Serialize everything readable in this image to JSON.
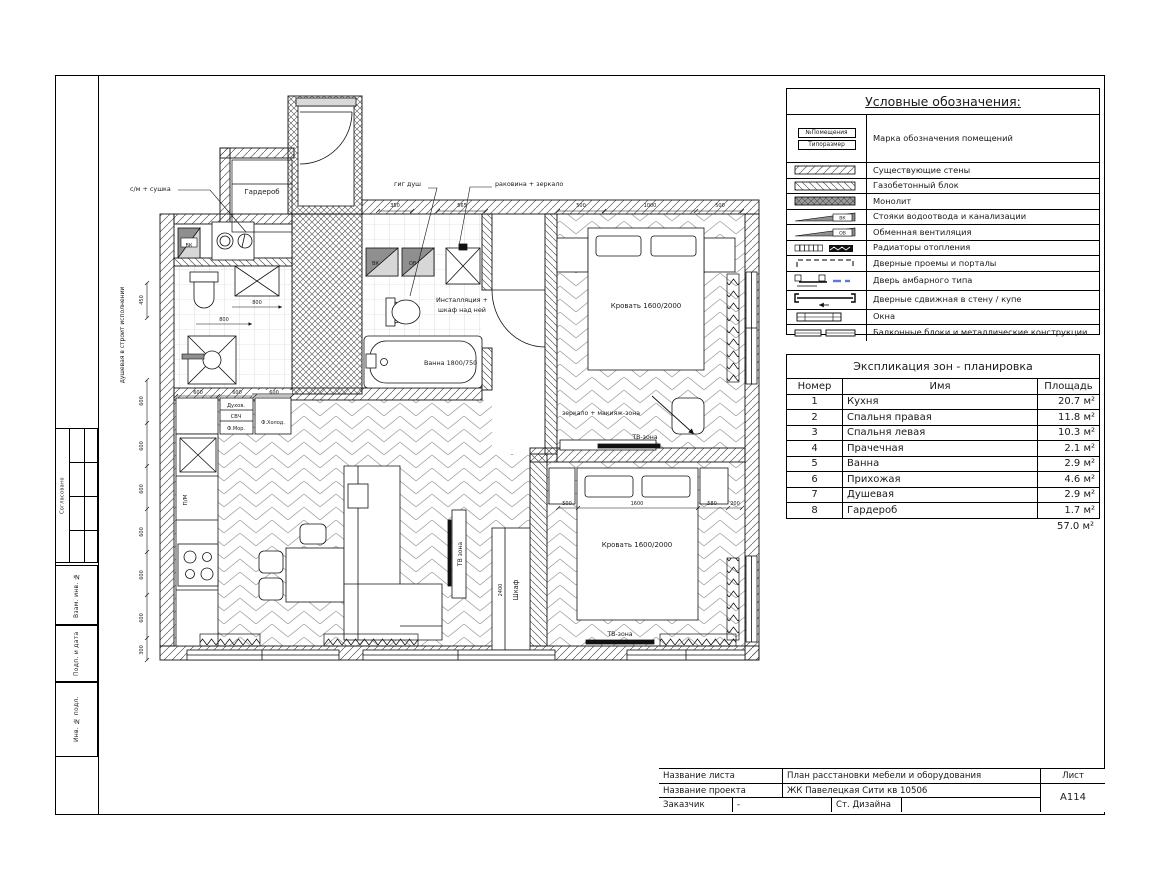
{
  "sheet": {
    "stamps": [
      "Согласовано",
      "Взам. инв. №",
      "Подп. и дата",
      "Инв. № подл."
    ]
  },
  "legend": {
    "title": "Условные обозначения:",
    "room_tag_top": "№Помещения",
    "room_tag_bottom": "Типоразмер",
    "vk": "ВК",
    "ov": "ОВ",
    "items": [
      "Марка обозначения помещений",
      "Существующие стены",
      "Газобетонный блок",
      "Монолит",
      "Стояки водоотвода и канализации",
      "Обменная вентиляция",
      "Радиаторы отопления",
      "Дверные проемы и порталы",
      "Дверь амбарного типа",
      "Дверные сдвижная в стену / купе",
      "Окна",
      "Балконные блоки и металлические конструкции"
    ]
  },
  "zones_table": {
    "title": "Экспликация зон - планировка",
    "headers": [
      "Номер",
      "Имя",
      "Площадь"
    ],
    "rows": [
      [
        "1",
        "Кухня",
        "20.7 м²"
      ],
      [
        "2",
        "Спальня правая",
        "11.8 м²"
      ],
      [
        "3",
        "Спальня левая",
        "10.3 м²"
      ],
      [
        "4",
        "Прачечная",
        "2.1 м²"
      ],
      [
        "5",
        "Ванна",
        "2.9 м²"
      ],
      [
        "6",
        "Прихожая",
        "4.6 м²"
      ],
      [
        "7",
        "Душевая",
        "2.9 м²"
      ],
      [
        "8",
        "Гардероб",
        "1.7 м²"
      ]
    ],
    "total": "57.0 м²"
  },
  "title_block": {
    "sheet_name_label": "Название листа",
    "sheet_name": "План расстановки мебели и оборудования",
    "project_label": "Название проекта",
    "project": "ЖК Павелецкая Сити кв 10506",
    "client_label": "Заказчик",
    "client": "-",
    "studio": "Ст. Дизайна",
    "sheet_label": "Лист",
    "sheet_number": "А114"
  },
  "plan": {
    "labels": {
      "washer": "с/м + сушка",
      "wardrobe_room": "Гардероб",
      "gig_shower": "гиг душ",
      "sink_mirror": "раковина + зеркало",
      "installation1": "Инсталляция +",
      "installation2": "шкаф над ней",
      "bath": "Ванна 1800/750",
      "bed_right": "Кровать 1600/2000",
      "bed_left": "Кровать 1600/2000",
      "mirror_makeup": "зеркало + макияж-зона",
      "tv_zone_right": "ТВ-зона",
      "tv_zone_left": "ТВ-зона",
      "tv_zone_living": "ТВ зона",
      "wardrobe_cab": "Шкаф",
      "oven": "Духов.",
      "micro": "СВЧ",
      "freezer": "Ф.Мор.",
      "fridge": "Ф.Холод.",
      "dishwasher": "П/М",
      "vk": "ВК",
      "ov": "ОВ",
      "shower_note": "душевая в строит исполнении"
    },
    "dims": {
      "d350": "350",
      "d565": "565",
      "d500": "500",
      "d1000": "1000",
      "d450": "450",
      "d600": "600",
      "d300": "300",
      "d800": "800",
      "d1600": "1600",
      "d580": "580",
      "d200": "200",
      "d2400": "2400"
    }
  }
}
